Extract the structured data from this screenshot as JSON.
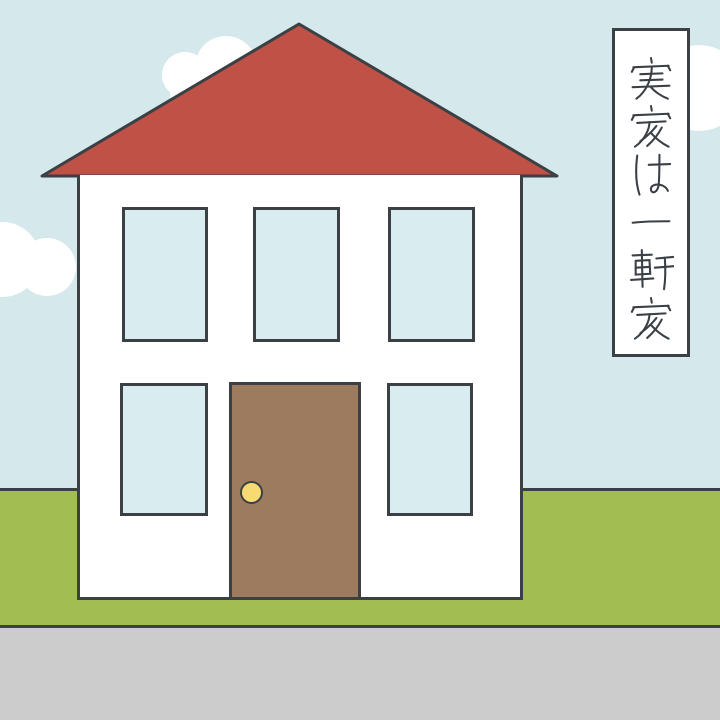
{
  "caption": {
    "text": "実家は一軒家",
    "characters": [
      "実",
      "家",
      "は",
      "一",
      "軒",
      "家"
    ],
    "orientation": "vertical-top-to-bottom"
  },
  "colors": {
    "sky": "#d5e8ec",
    "window": "#d9ecf0",
    "grass": "#a2be53",
    "road": "#cccccc",
    "roof": "#bf5147",
    "wall": "#ffffff",
    "door": "#9c7b5e",
    "knob": "#f7db72",
    "outline": "#3a4043",
    "cloud": "#ffffff",
    "caption_bg": "#ffffff",
    "ink": "#3a4045"
  },
  "scene": {
    "elements": [
      "sky",
      "clouds",
      "roof",
      "house-wall",
      "windows",
      "door",
      "doorknob",
      "grass",
      "road",
      "caption-box"
    ],
    "upper_window_count": 3,
    "lower_window_count": 2,
    "cloud_count": 3
  }
}
